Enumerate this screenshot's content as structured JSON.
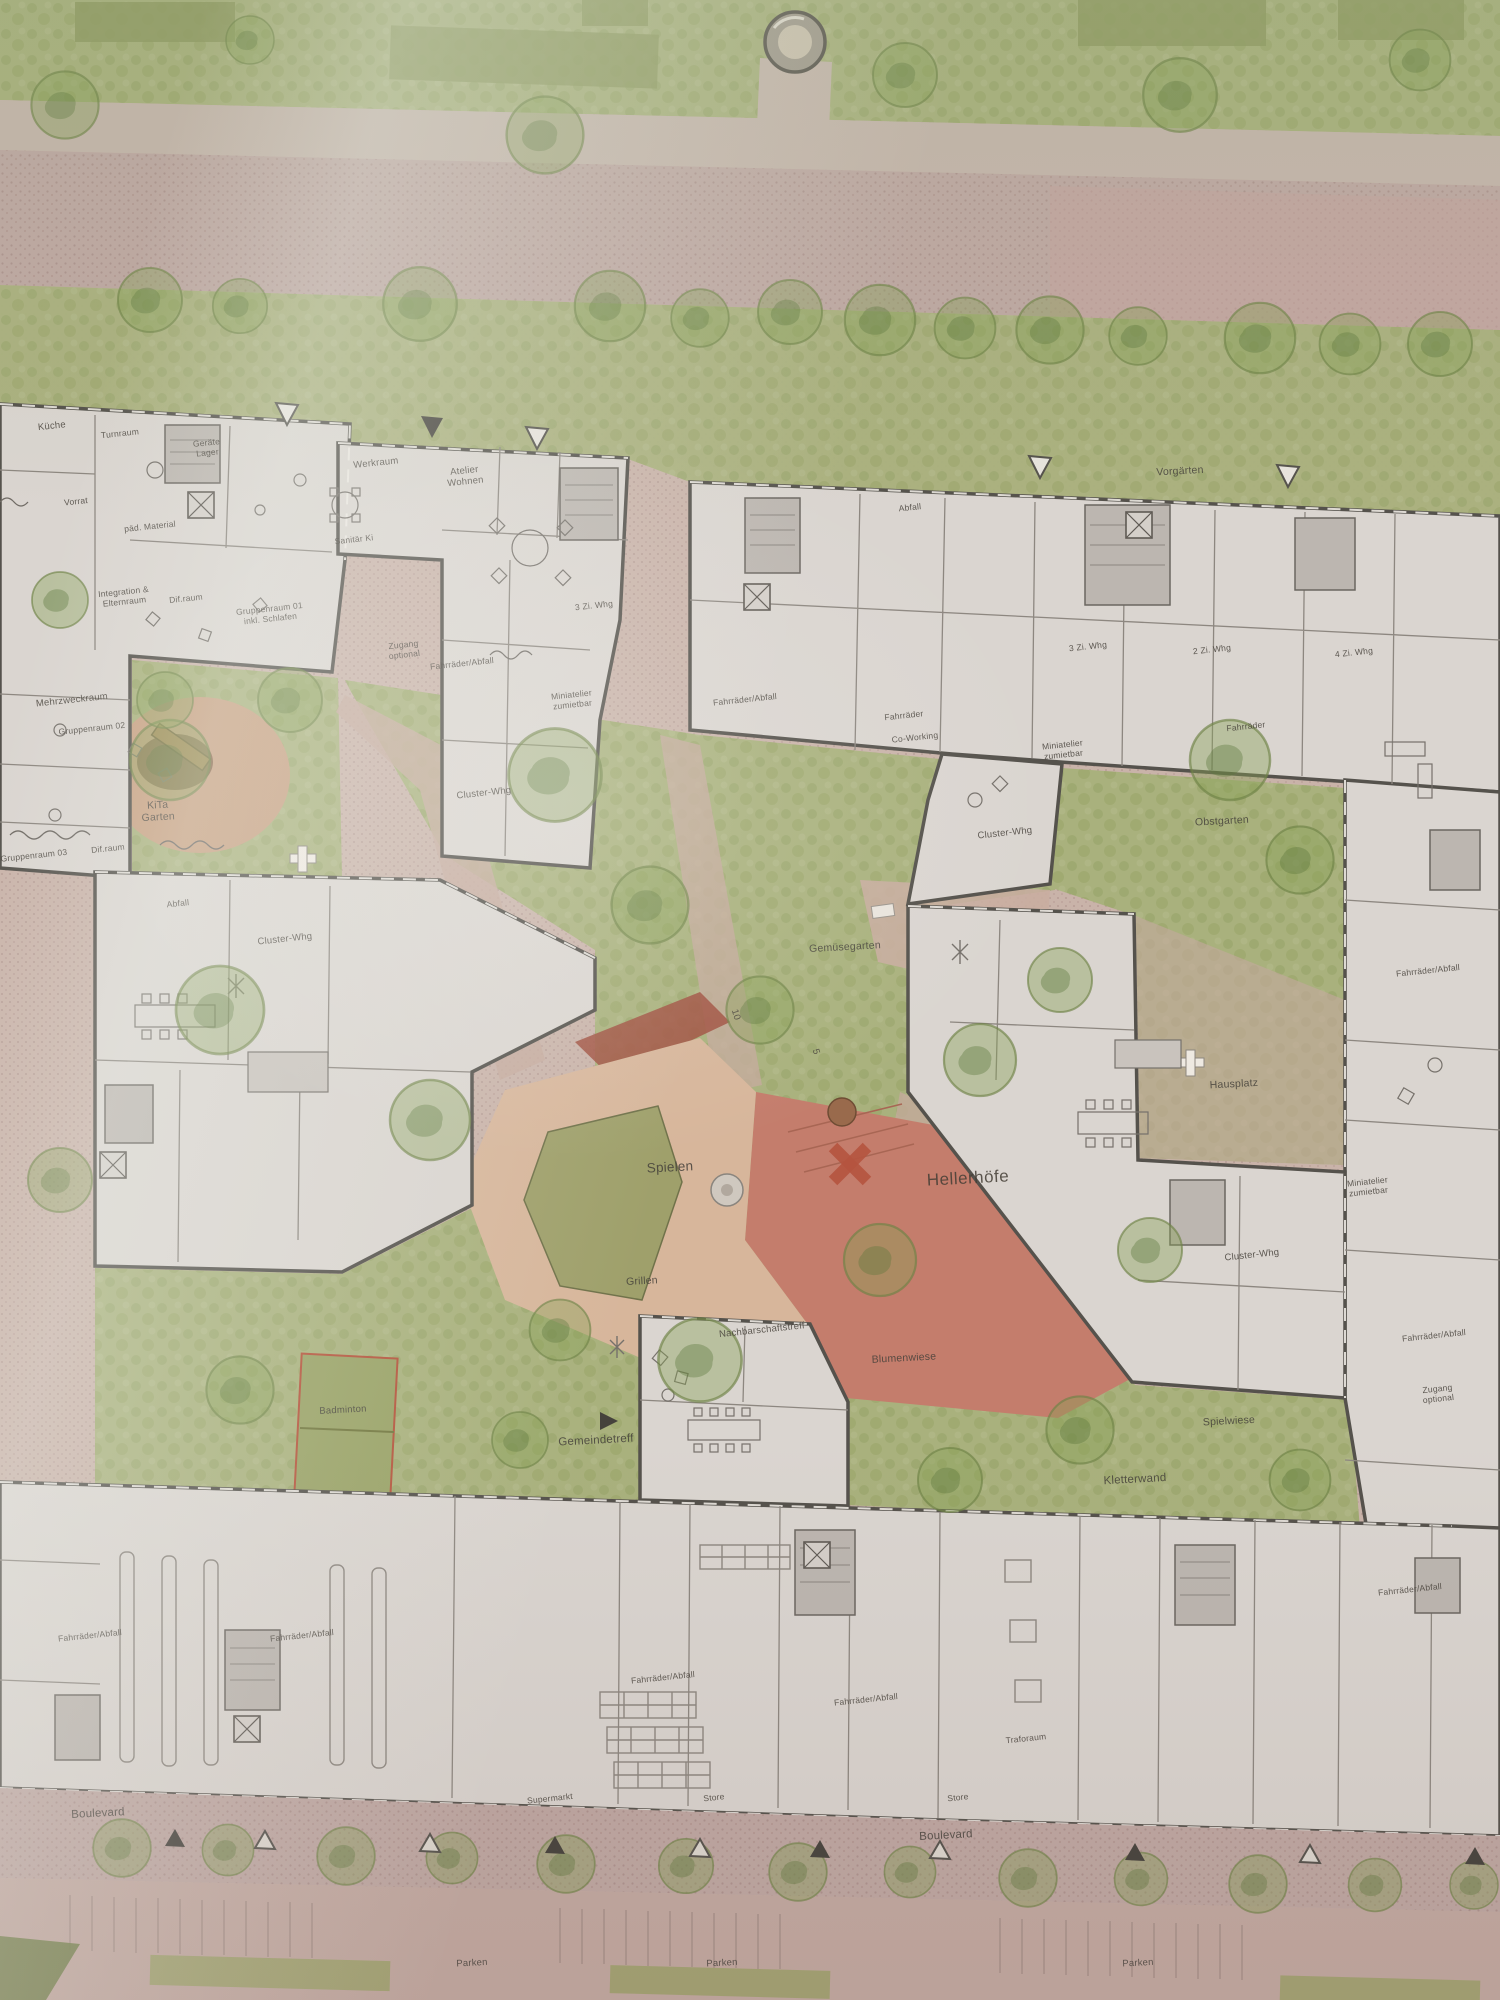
{
  "plan": {
    "name_label": "Hellerhöfe",
    "type": "architectural site plan photo (ground floor / landscape plan)"
  },
  "palette": {
    "paper_paving": "#c9b3a9",
    "street": "#bfa8a3",
    "lawn": "#a9b17d",
    "building_fill": "#dad5d0",
    "wall": "#55524c",
    "plaza_red": "#c47d6c",
    "path_dark_red": "#a05040",
    "sand": "#d7b69b",
    "water_feature_olive": "#9fa06b",
    "label_ink": "#46413a"
  },
  "markers": {
    "entrance_triangle_down": "▽",
    "entrance_triangle_down_filled": "▼",
    "boulevard_triangle_up": "△",
    "boulevard_triangle_up_filled": "▲",
    "gemeindetreff_arrow": "▶"
  },
  "labels": [
    {
      "id": "kueche",
      "text": "Küche"
    },
    {
      "id": "turnraum",
      "text": "Turnraum"
    },
    {
      "id": "geraete-lager",
      "text": "Geräte\nLager"
    },
    {
      "id": "vorrat",
      "text": "Vorrat"
    },
    {
      "id": "paed-material",
      "text": "päd. Material"
    },
    {
      "id": "werkraum",
      "text": "Werkraum"
    },
    {
      "id": "atelier-wohnen",
      "text": "Atelier\nWohnen"
    },
    {
      "id": "sanitaer-ki",
      "text": "Sanitär Ki"
    },
    {
      "id": "integration-elternraum",
      "text": "Integration &\nElternraum"
    },
    {
      "id": "difraum-1",
      "text": "Dif.raum"
    },
    {
      "id": "gruppenraum-01",
      "text": "Gruppenraum 01\ninkl. Schlafen"
    },
    {
      "id": "zugang-optional-1",
      "text": "Zugang\noptional"
    },
    {
      "id": "fahrraeder-abfall-1",
      "text": "Fahrräder/Abfall"
    },
    {
      "id": "miniatelier-1",
      "text": "Miniatelier\nzumietbar"
    },
    {
      "id": "fahrraeder-abfall-2",
      "text": "Fahrräder/Abfall"
    },
    {
      "id": "cluster-whg-1",
      "text": "Cluster-Whg"
    },
    {
      "id": "whg-3zi-1",
      "text": "3 Zi. Whg"
    },
    {
      "id": "mehrzweckraum",
      "text": "Mehrzweckraum"
    },
    {
      "id": "gruppenraum-02",
      "text": "Gruppenraum 02"
    },
    {
      "id": "difraum-2",
      "text": "Dif.raum"
    },
    {
      "id": "gruppenraum-03",
      "text": "Gruppenraum 03"
    },
    {
      "id": "kita-garten",
      "text": "KiTa\nGarten"
    },
    {
      "id": "abfall-1",
      "text": "Abfall"
    },
    {
      "id": "vorgaerten",
      "text": "Vorgärten"
    },
    {
      "id": "whg-3zi-2",
      "text": "3 Zi. Whg"
    },
    {
      "id": "whg-2zi",
      "text": "2 Zi. Whg"
    },
    {
      "id": "whg-4zi",
      "text": "4 Zi. Whg"
    },
    {
      "id": "fahrraeder-1",
      "text": "Fahrräder"
    },
    {
      "id": "co-working",
      "text": "Co-Working"
    },
    {
      "id": "miniatelier-2",
      "text": "Miniatelier\nzumietbar"
    },
    {
      "id": "fahrraeder-2",
      "text": "Fahrräder"
    },
    {
      "id": "cluster-whg-2",
      "text": "Cluster-Whg"
    },
    {
      "id": "obstgarten",
      "text": "Obstgarten"
    },
    {
      "id": "gemuesegarten",
      "text": "Gemüsegarten"
    },
    {
      "id": "hausplatz",
      "text": "Hausplatz"
    },
    {
      "id": "fahrraeder-abfall-3",
      "text": "Fahrräder/Abfall"
    },
    {
      "id": "miniatelier-3",
      "text": "Miniatelier\nzumietbar"
    },
    {
      "id": "cluster-whg-3",
      "text": "Cluster-Whg"
    },
    {
      "id": "fahrraeder-abfall-4",
      "text": "Fahrräder/Abfall"
    },
    {
      "id": "zugang-optional-2",
      "text": "Zugang optional"
    },
    {
      "id": "abfall-2",
      "text": "Abfall"
    },
    {
      "id": "cluster-whg-4",
      "text": "Cluster-Whg"
    },
    {
      "id": "spielen",
      "text": "Spielen"
    },
    {
      "id": "hellerhoefe",
      "text": "Hellerhöfe"
    },
    {
      "id": "grillen",
      "text": "Grillen"
    },
    {
      "id": "nachbarschaftstreff",
      "text": "Nachbarschaftstreff"
    },
    {
      "id": "blumenwiese",
      "text": "Blumenwiese"
    },
    {
      "id": "badminton",
      "text": "Badminton"
    },
    {
      "id": "gemeindetreff",
      "text": "Gemeindetreff"
    },
    {
      "id": "spielwiese",
      "text": "Spielwiese"
    },
    {
      "id": "kletterwand",
      "text": "Kletterwand"
    },
    {
      "id": "fahrraeder-abfall-5",
      "text": "Fahrräder/Abfall"
    },
    {
      "id": "fahrraeder-abfall-6",
      "text": "Fahrräder/Abfall"
    },
    {
      "id": "fahrraeder-abfall-7",
      "text": "Fahrräder/Abfall"
    },
    {
      "id": "fahrraeder-abfall-8",
      "text": "Fahrräder/Abfall"
    },
    {
      "id": "fahrraeder-abfall-9",
      "text": "Fahrräder/Abfall"
    },
    {
      "id": "supermarkt",
      "text": "Supermarkt"
    },
    {
      "id": "store-1",
      "text": "Store"
    },
    {
      "id": "store-2",
      "text": "Store"
    },
    {
      "id": "traforaum",
      "text": "Traforaum"
    },
    {
      "id": "boulevard-1",
      "text": "Boulevard"
    },
    {
      "id": "boulevard-2",
      "text": "Boulevard"
    },
    {
      "id": "parken-1",
      "text": "Parken"
    },
    {
      "id": "parken-2",
      "text": "Parken"
    },
    {
      "id": "parken-3",
      "text": "Parken"
    },
    {
      "id": "steps-count-10",
      "text": "10"
    },
    {
      "id": "steps-count-5",
      "text": "5"
    }
  ]
}
